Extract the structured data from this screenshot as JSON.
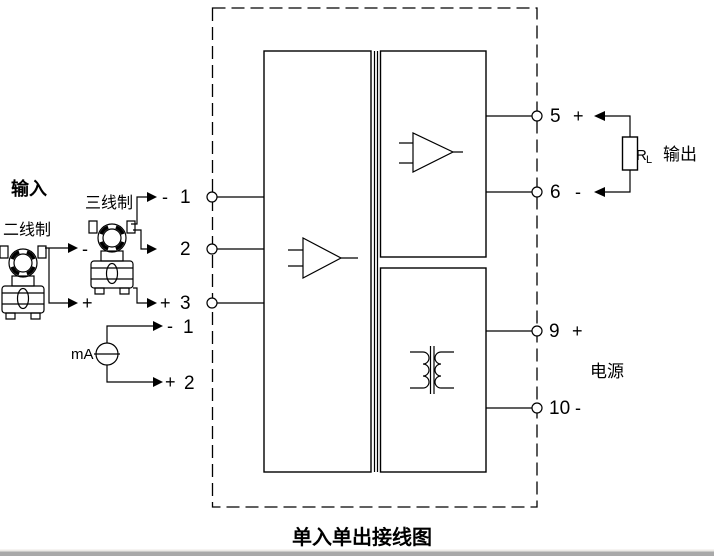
{
  "title": "单入单出接线图",
  "labels": {
    "input": "输入",
    "two_wire": "二线制",
    "three_wire": "三线制",
    "ma_source": "mA",
    "load_resistor": "R",
    "load_resistor_sub": "L",
    "output": "输出",
    "power": "电源"
  },
  "terminals": {
    "left": [
      {
        "num": "1",
        "sign": "-"
      },
      {
        "num": "2",
        "sign": ""
      },
      {
        "num": "3",
        "sign": "+"
      }
    ],
    "left_alt": [
      {
        "num": "1",
        "sign": "-"
      },
      {
        "num": "2",
        "sign": "+"
      }
    ],
    "right": [
      {
        "num": "5",
        "sign": "+"
      },
      {
        "num": "6",
        "sign": "-"
      },
      {
        "num": "9",
        "sign": "+"
      },
      {
        "num": "10",
        "sign": "-"
      }
    ]
  },
  "two_wire_signs": {
    "minus": "-",
    "plus": "+"
  },
  "colors": {
    "line": "#000000",
    "background": "#ffffff",
    "window_edge": "#a9a9a9"
  }
}
